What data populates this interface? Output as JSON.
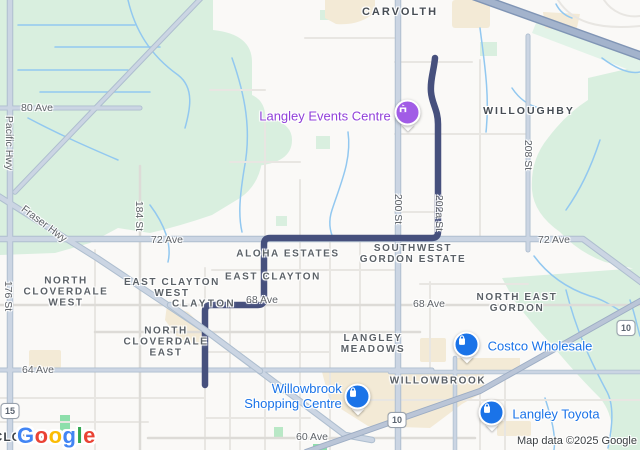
{
  "map": {
    "attribution": "Map data ©2025 Google",
    "google_logo": [
      "G",
      "o",
      "o",
      "g",
      "l",
      "e"
    ],
    "colors": {
      "route": "#46507d",
      "poi_blue": "#1a73e8",
      "poi_purple_pin": "#a15ce6",
      "poi_purple_text": "#9141d9",
      "vegetation": "#d9efdf",
      "commercial": "#f3ead6",
      "arterial": "#cbd5e3",
      "motorway": "#a3b3cc",
      "stream": "#92c8f0",
      "logo_colors": [
        "#4285f4",
        "#ea4335",
        "#fbbc05",
        "#4285f4",
        "#34a853",
        "#ea4335"
      ]
    },
    "icons": {
      "events_centre": "arts-centre-icon",
      "costco": "shopping-bag-icon",
      "willowbrook_sc": "shopping-bag-icon",
      "langley_toyota": "shopping-bag-icon"
    },
    "shields": {
      "hwy15": "15",
      "hwy10": "10"
    },
    "streets": {
      "ave80": "80 Ave",
      "ave72": "72 Ave",
      "ave68": "68 Ave",
      "ave64": "64 Ave",
      "ave60": "60 Ave",
      "st176": "176 St",
      "st184": "184 St",
      "st200": "200 St",
      "st202a": "202a St",
      "st208": "208 St",
      "pacific_hwy": "Pacific Hwy",
      "fraser_hwy": "Fraser Hwy"
    },
    "areas": {
      "carvolth": "CARVOLTH",
      "willoughby": "WILLOUGHBY",
      "aloha_estates": "ALOHA ESTATES",
      "southwest_gordon": [
        "SOUTHWEST",
        "GORDON ESTATE"
      ],
      "east_clayton": "EAST CLAYTON",
      "east_clayton_west": [
        "EAST CLAYTON",
        "WEST"
      ],
      "clayton": "CLAYTON",
      "north_cloverdale_west": [
        "NORTH",
        "CLOVERDALE",
        "WEST"
      ],
      "north_cloverdale_east": [
        "NORTH",
        "CLOVERDALE",
        "EAST"
      ],
      "north_east_gordon": [
        "NORTH EAST",
        "GORDON"
      ],
      "langley_meadows": [
        "LANGLEY",
        "MEADOWS"
      ],
      "willowbrook": "WILLOWBROOK",
      "cloverdale": "CLOVERDALE"
    },
    "pois": {
      "events_centre": "Langley Events Centre",
      "costco": "Costco Wholesale",
      "willowbrook_sc": [
        "Willowbrook",
        "Shopping Centre"
      ],
      "langley_toyota": "Langley Toyota"
    }
  }
}
